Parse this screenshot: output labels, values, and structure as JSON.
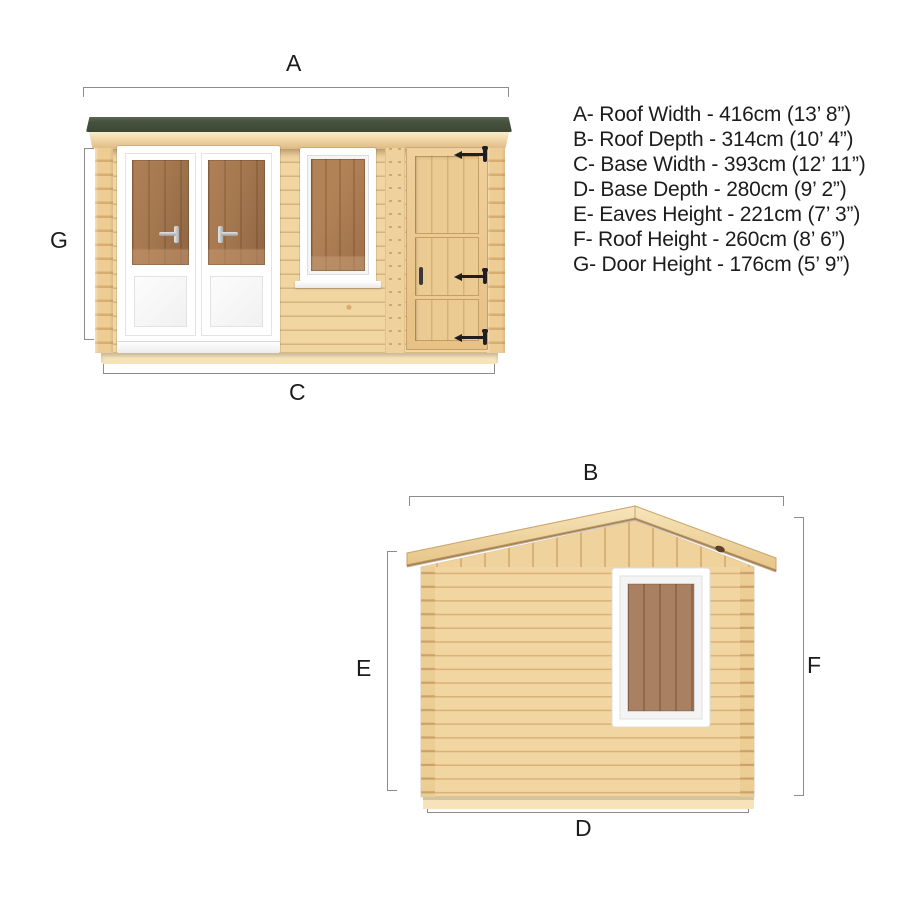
{
  "colors": {
    "bg": "#ffffff",
    "wood": "#f2d6a2",
    "wood-dark": "#e2bc82",
    "roof": "#46513d",
    "glass-amber": "#a87c54",
    "glass-brown": "#9b6f4e",
    "frame-white": "#ffffff",
    "hinge": "#1f1f1f",
    "dim": "#8c8c8c",
    "label": "#1c1c1c"
  },
  "legend": {
    "lines": [
      "A- Roof Width - 416cm (13’ 8”)",
      "B- Roof Depth - 314cm (10’ 4”)",
      "C- Base Width - 393cm (12’ 11”)",
      "D- Base Depth - 280cm (9’ 2”)",
      "E- Eaves Height - 221cm (7’ 3”)",
      "F- Roof Height - 260cm (8’ 6”)",
      "G- Door Height - 176cm (5’ 9”)"
    ]
  },
  "front_view": {
    "label_top": "A",
    "label_left": "G",
    "label_bottom": "C"
  },
  "side_view": {
    "label_top": "B",
    "label_left": "E",
    "label_right": "F",
    "label_bottom": "D"
  }
}
